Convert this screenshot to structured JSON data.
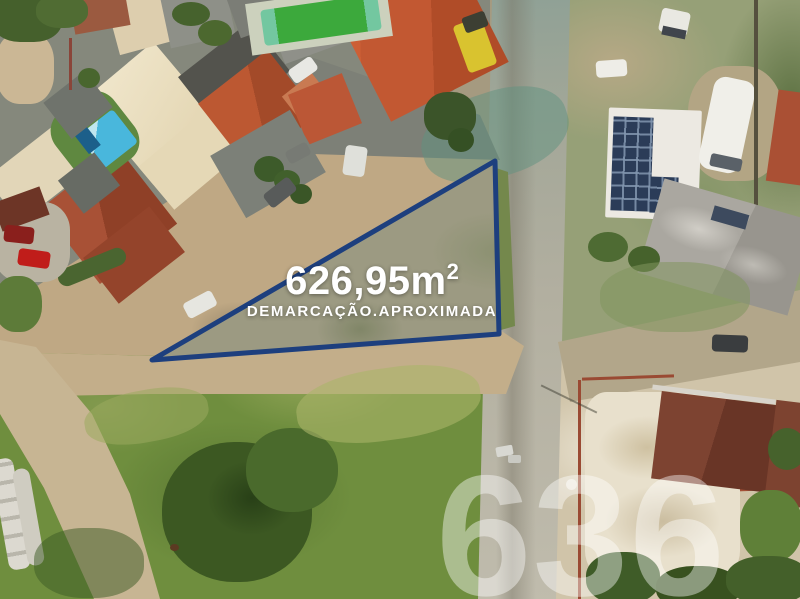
{
  "meta": {
    "kind": "aerial drone photograph of a vacant land plot for sale",
    "canvas": {
      "width_px": 800,
      "height_px": 599
    }
  },
  "overlay": {
    "area_value": "626,95m",
    "area_exponent": "2",
    "demarcation_note": "DEMARCAÇÃO.APROXIMADA",
    "text_color": "#ffffff"
  },
  "demarcation": {
    "triangle_points": "495,161 152,360 499,334",
    "stroke_color": "#1d3f7e",
    "stroke_width": 5
  },
  "watermark": {
    "text": "636",
    "color": "rgba(255,255,255,0.42)"
  },
  "scene": {
    "description": "Aerial top-down view: residential block with red tile roofs, cream hip roof and two swimming pools at top left, sandy dirt road running diagonally, paved street on the right, triangular vacant scrub lot in the centre outlined in blue, green field with large tree cluster at bottom left, white building with solar panels and white motorhome on the right, dark red roofed houses at bottom right",
    "colors": {
      "dirt_road": "#bfa884",
      "paved_road": "#b2afa0",
      "vacant_lot": "#98967d",
      "field_green": "#6f8e3e",
      "tree_green": "#3c5822",
      "terracotta_roof": "#a85136",
      "cream_roof": "#e9ddbe",
      "pool_blue": "#49b7dc",
      "pool_green": "#3ca93c",
      "solar_panel": "#2b3c58"
    }
  }
}
